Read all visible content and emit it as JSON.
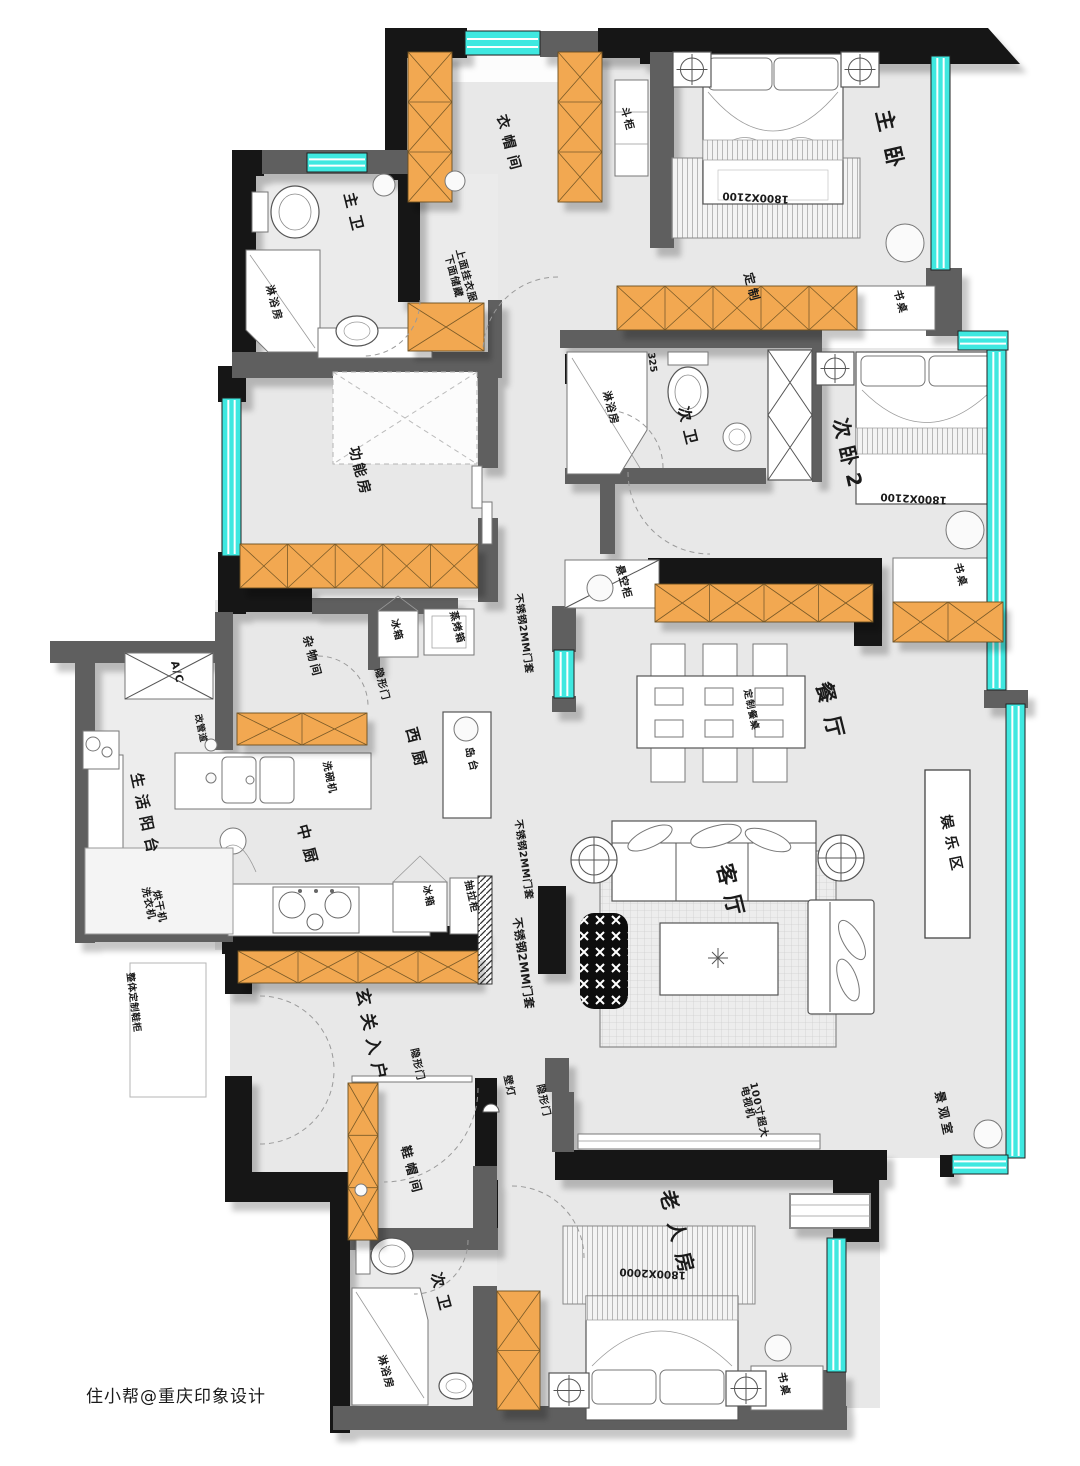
{
  "colors": {
    "wall_black": "#181818",
    "wall_gray": "#5f5f5f",
    "window_glass": "#3fe8e0",
    "cabinet_orange": "#f2a851",
    "floor_gray": "#e8e8e8"
  },
  "labels": [
    {
      "id": "zhu-wo",
      "text": "主卧",
      "kind": "room"
    },
    {
      "id": "yi-mao-jian",
      "text": "衣帽间",
      "kind": "room"
    },
    {
      "id": "zhu-wei",
      "text": "主卫",
      "kind": "room"
    },
    {
      "id": "gong-neng-fang",
      "text": "功能房",
      "kind": "room"
    },
    {
      "id": "ci-wo-2",
      "text": "次卧2",
      "kind": "room"
    },
    {
      "id": "ci-wei-upper",
      "text": "次卫",
      "kind": "room"
    },
    {
      "id": "can-ting",
      "text": "餐厅",
      "kind": "room"
    },
    {
      "id": "ke-ting",
      "text": "客厅",
      "kind": "room"
    },
    {
      "id": "yu-le-qu",
      "text": "娱乐区",
      "kind": "room"
    },
    {
      "id": "xi-chu",
      "text": "西厨",
      "kind": "room"
    },
    {
      "id": "zhong-chu",
      "text": "中厨",
      "kind": "room"
    },
    {
      "id": "sheng-huo-yang-tai",
      "text": "生活阳台",
      "kind": "room"
    },
    {
      "id": "za-wu-jian",
      "text": "杂物间",
      "kind": "room"
    },
    {
      "id": "xuan-guan-ru-hu",
      "text": "玄关入户",
      "kind": "room"
    },
    {
      "id": "xie-mao-jian",
      "text": "鞋帽间",
      "kind": "room"
    },
    {
      "id": "ci-wei-lower",
      "text": "次卫",
      "kind": "room"
    },
    {
      "id": "lao-ren-fang",
      "text": "老人房",
      "kind": "room"
    },
    {
      "id": "jing-guan-shi",
      "text": "景观室",
      "kind": "room"
    },
    {
      "id": "dou-gui",
      "text": "斗柜",
      "kind": "furniture"
    },
    {
      "id": "lin-yu-fang-1",
      "text": "淋浴房",
      "kind": "furniture"
    },
    {
      "id": "note-hang",
      "text": "上面挂衣服",
      "kind": "note"
    },
    {
      "id": "note-store",
      "text": "下面储藏",
      "kind": "note"
    },
    {
      "id": "ding-zhi",
      "text": "定制",
      "kind": "note"
    },
    {
      "id": "shu-zhuo-1",
      "text": "书桌",
      "kind": "furniture"
    },
    {
      "id": "lin-yu-fang-2",
      "text": "淋浴房",
      "kind": "furniture"
    },
    {
      "id": "xuan-kong-gui",
      "text": "悬空柜",
      "kind": "furniture"
    },
    {
      "id": "shu-zhuo-2",
      "text": "书桌",
      "kind": "furniture"
    },
    {
      "id": "ding-zhi-can-zhuo",
      "text": "定制餐桌",
      "kind": "furniture"
    },
    {
      "id": "bing-xiang-1",
      "text": "冰箱",
      "kind": "furniture"
    },
    {
      "id": "zheng-kao-xiang",
      "text": "蒸烤箱",
      "kind": "furniture"
    },
    {
      "id": "yin-xing-men-1",
      "text": "隐形门",
      "kind": "note"
    },
    {
      "id": "bu-xiu-gang-1",
      "text": "不锈钢2MM门套",
      "kind": "note"
    },
    {
      "id": "bu-xiu-gang-2",
      "text": "不锈钢2MM门套",
      "kind": "note"
    },
    {
      "id": "bu-xiu-gang-3",
      "text": "不锈钢2MM门套",
      "kind": "note"
    },
    {
      "id": "dao-tai",
      "text": "岛台",
      "kind": "furniture"
    },
    {
      "id": "gai-guan-dao",
      "text": "改管道",
      "kind": "note"
    },
    {
      "id": "xi-wan-ji",
      "text": "洗碗机",
      "kind": "furniture"
    },
    {
      "id": "ac",
      "text": "A/C",
      "kind": "furniture"
    },
    {
      "id": "xi-yi-ji",
      "text": "洗衣机",
      "kind": "furniture"
    },
    {
      "id": "hong-gan-ji",
      "text": "烘干机",
      "kind": "furniture"
    },
    {
      "id": "zheng-ti-xie-gui",
      "text": "整体定制鞋柜",
      "kind": "note"
    },
    {
      "id": "yin-xing-men-2",
      "text": "隐形门",
      "kind": "note"
    },
    {
      "id": "yin-xing-men-3",
      "text": "隐形门",
      "kind": "note"
    },
    {
      "id": "bi-deng",
      "text": "壁灯",
      "kind": "note"
    },
    {
      "id": "chou-la-gui",
      "text": "抽拉柜",
      "kind": "furniture"
    },
    {
      "id": "bing-xiang-2",
      "text": "冰箱",
      "kind": "furniture"
    },
    {
      "id": "lin-yu-fang-3",
      "text": "淋浴房",
      "kind": "furniture"
    },
    {
      "id": "tv-size",
      "text": "100寸超大",
      "kind": "note"
    },
    {
      "id": "tv-name",
      "text": "电视机",
      "kind": "note"
    },
    {
      "id": "shu-zhuo-3",
      "text": "书桌",
      "kind": "furniture"
    },
    {
      "id": "bed-dim-1",
      "text": "1800X2100",
      "kind": "dimension"
    },
    {
      "id": "bed-dim-2",
      "text": "1800X2100",
      "kind": "dimension"
    },
    {
      "id": "bed-dim-3",
      "text": "1800X2000",
      "kind": "dimension"
    },
    {
      "id": "dim-325",
      "text": "325",
      "kind": "dimension"
    },
    {
      "id": "watermark",
      "text": "住小帮@重庆印象设计",
      "kind": "watermark"
    }
  ]
}
